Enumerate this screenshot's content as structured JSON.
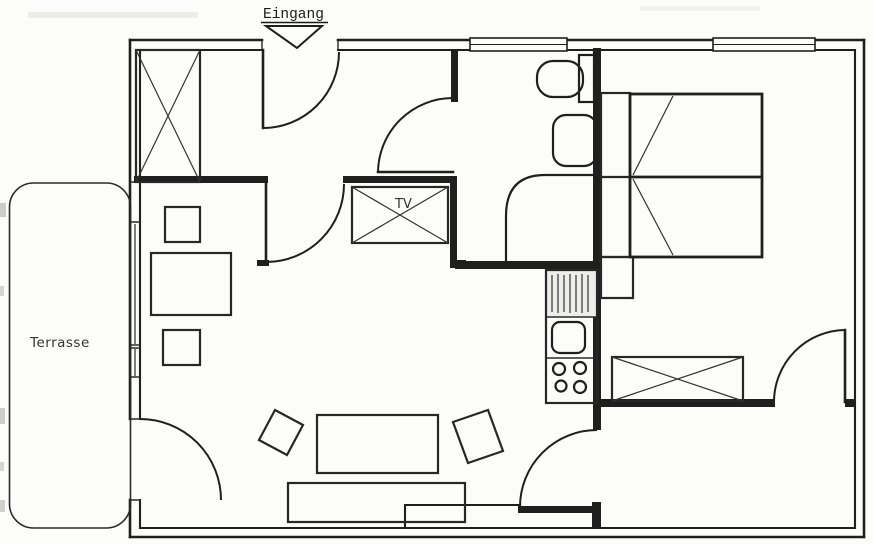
{
  "meta": {
    "type": "floor-plan-scan",
    "ink_color": "#1f1f1f",
    "paper_color": "#fcfcfb"
  },
  "labels": {
    "entrance": "Eingang",
    "terrace": "Terrasse",
    "tv": "TV"
  }
}
